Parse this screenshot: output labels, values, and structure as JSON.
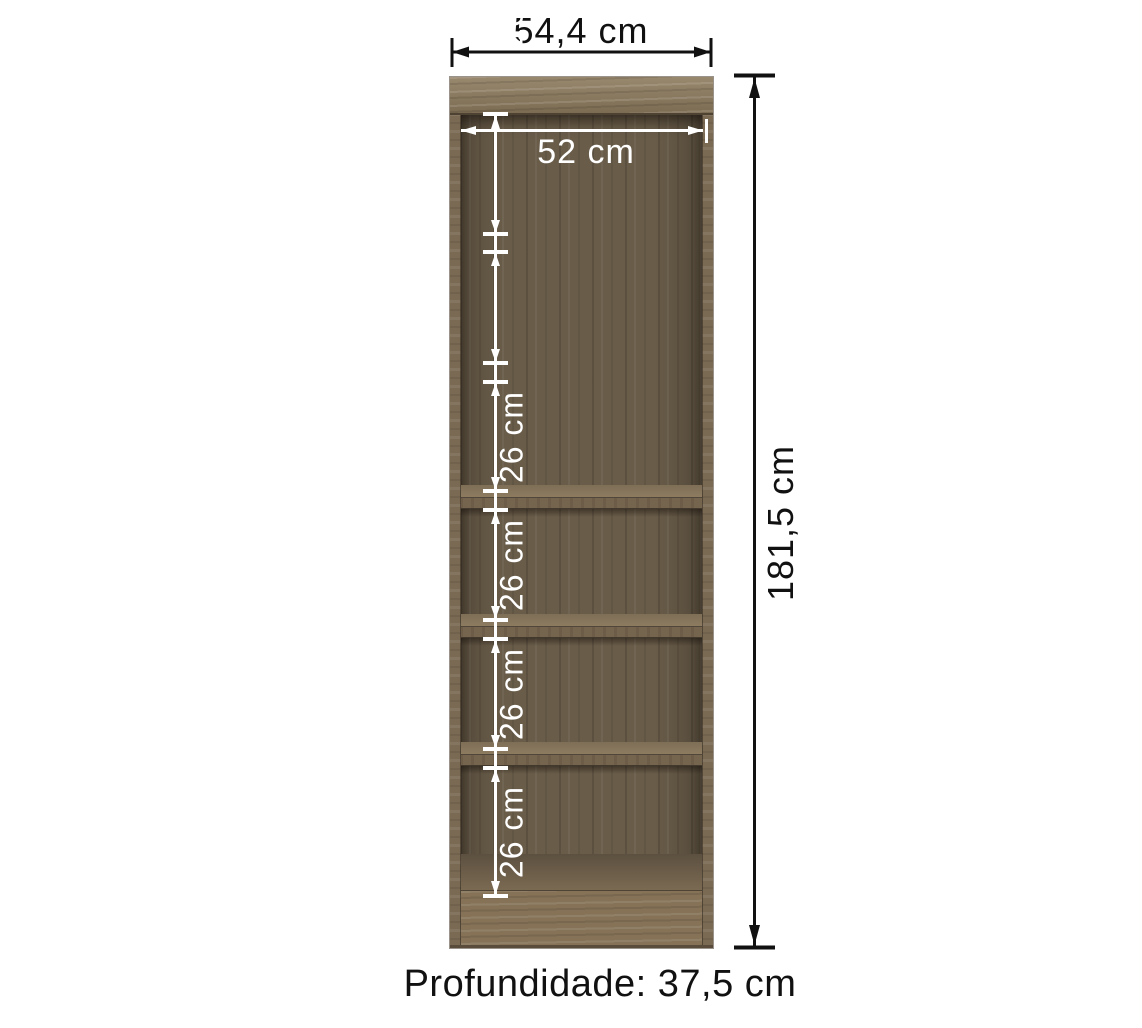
{
  "diagram": {
    "product": "bookcase-dimension-diagram",
    "width_label": "54,4 cm",
    "inner_width_label": "52 cm",
    "height_label": "181,5 cm",
    "depth_label": "Profundidade: 37,5 cm",
    "sections": [
      {
        "label": "26 cm"
      },
      {
        "label": "26 cm"
      },
      {
        "label": "26 cm"
      },
      {
        "label": "26 cm"
      },
      {
        "label": "26 cm"
      },
      {
        "label": "26 cm"
      }
    ],
    "colors": {
      "background": "#ffffff",
      "dimension_black": "#111111",
      "dimension_white": "#ffffff",
      "wood_light": "#8d7b5e",
      "wood_medium": "#7a6a53",
      "wood_dark": "#695c49"
    }
  }
}
